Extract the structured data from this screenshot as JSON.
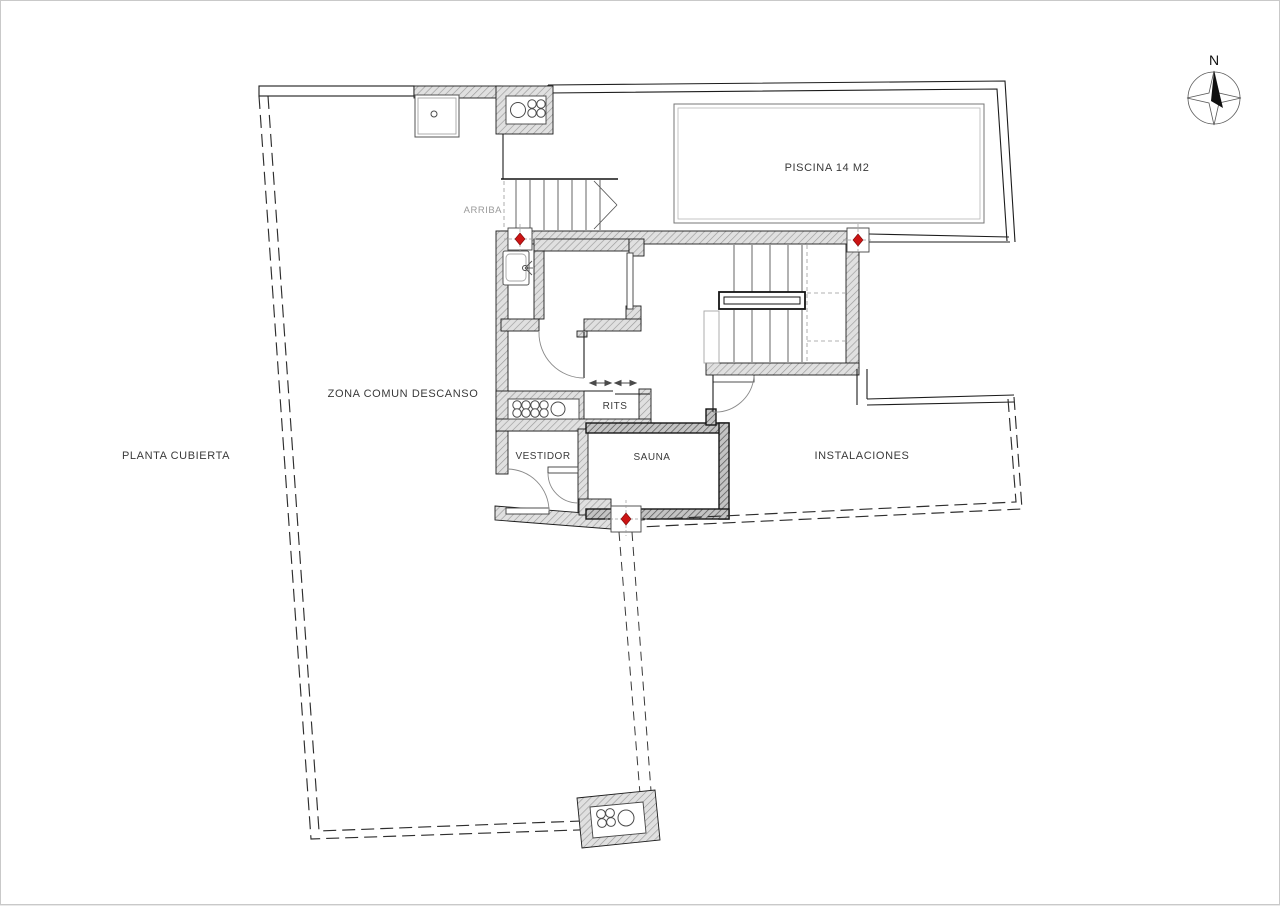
{
  "plan": {
    "title": "PLANTA CUBIERTA",
    "rooms": {
      "zona_comun": "ZONA COMUN DESCANSO",
      "piscina": "PISCINA 14 M2",
      "rits": "RITS",
      "vestidor": "VESTIDOR",
      "sauna": "SAUNA",
      "instalaciones": "INSTALACIONES"
    },
    "annotations": {
      "arriba": "ARRIBA",
      "compass_north": "N"
    },
    "colors": {
      "marker_red": "#cc1414",
      "wall_fill": "#e0e0e0",
      "wall_hatch_line": "#9a9a9a",
      "line_dark": "#1c1c1c",
      "text": "#3a3a3a",
      "text_light": "#9a9a9a",
      "page_bg": "#ffffff"
    }
  }
}
